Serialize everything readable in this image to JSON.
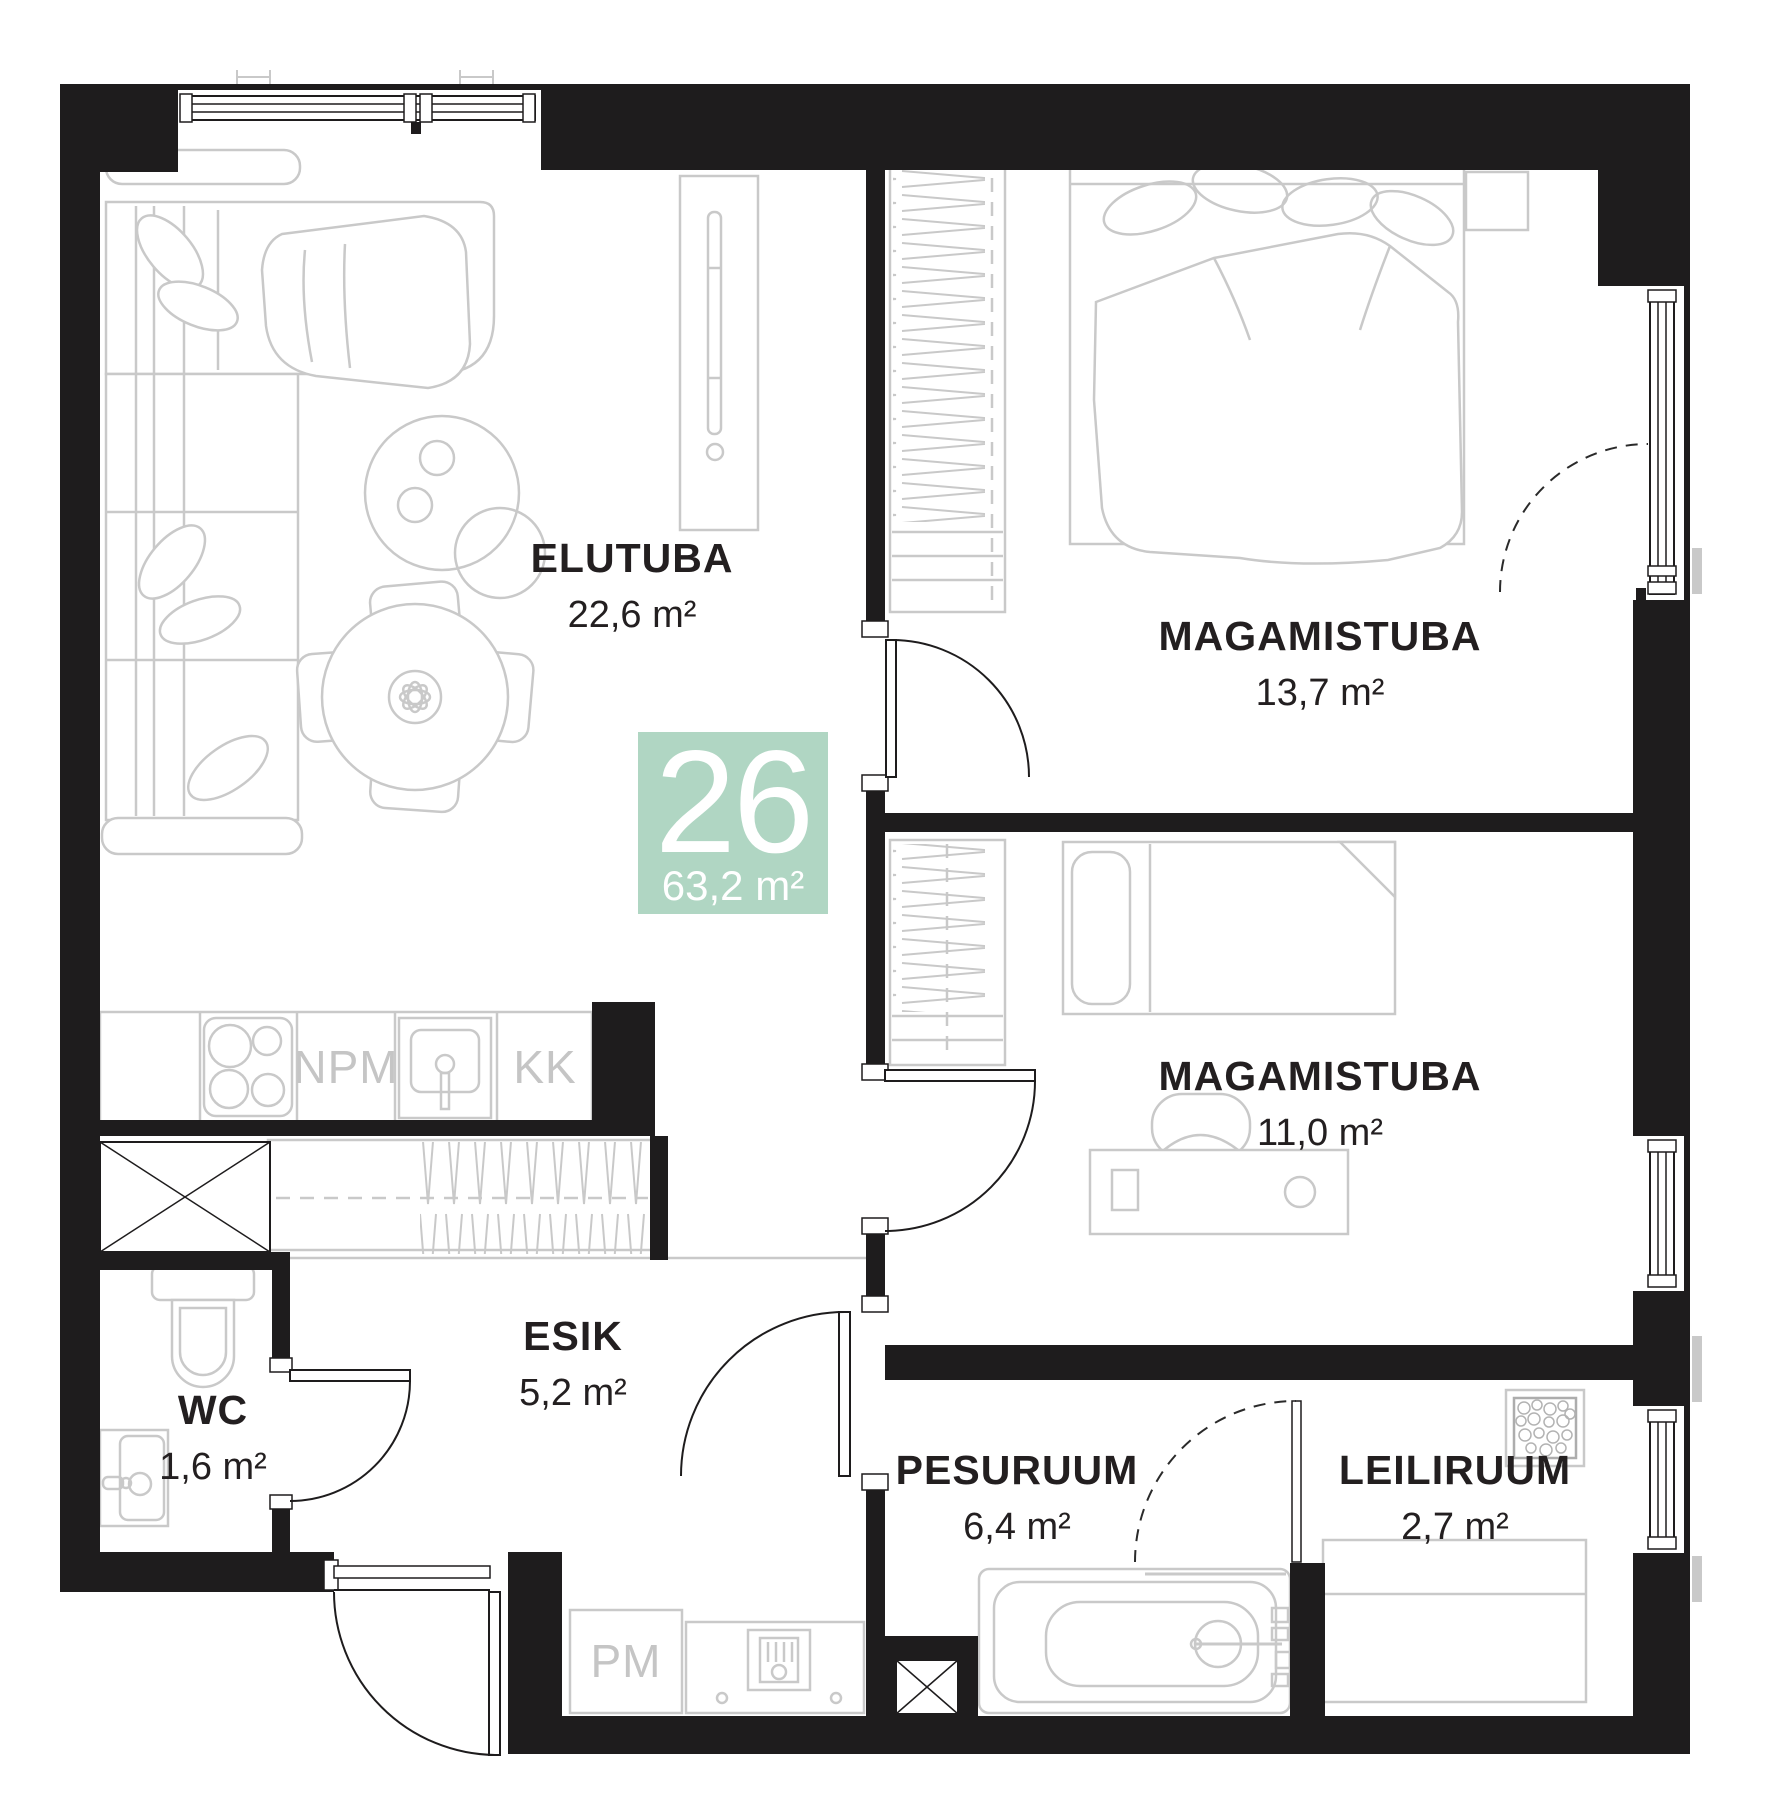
{
  "plan": {
    "unit_number": "26",
    "total_area": "63,2 m²",
    "rooms": [
      {
        "name": "ELUTUBA",
        "area": "22,6 m²"
      },
      {
        "name": "MAGAMISTUBA",
        "area": "13,7 m²"
      },
      {
        "name": "MAGAMISTUBA",
        "area": "11,0 m²"
      },
      {
        "name": "ESIK",
        "area": "5,2 m²"
      },
      {
        "name": "WC",
        "area": "1,6 m²"
      },
      {
        "name": "PESURUUM",
        "area": "6,4 m²"
      },
      {
        "name": "LEILIRUUM",
        "area": "2,7 m²"
      }
    ],
    "fixtures": {
      "npm": "NPM",
      "kk": "KK",
      "pm": "PM"
    },
    "colors": {
      "badge_bg": "#b0d6c3",
      "badge_text": "#ffffff",
      "wall": "#1e1c1d",
      "furniture_line": "#c9c9c9",
      "label_text": "#231f20",
      "fixture_label_text": "#c5c5c5"
    }
  }
}
